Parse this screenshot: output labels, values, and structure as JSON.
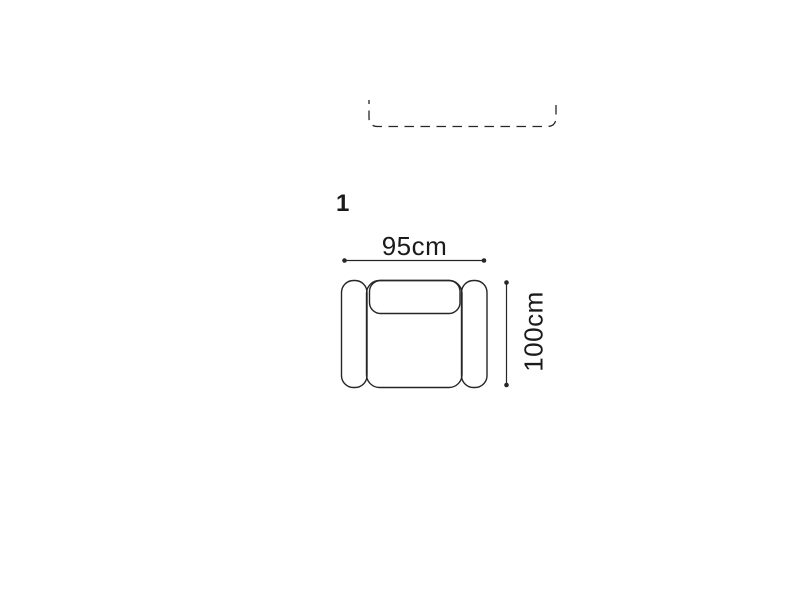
{
  "scene": {
    "background": "#ffffff",
    "line_color": "#262626",
    "text_color": "#1a1a1a",
    "description": "Top-view dimension diagram of an armchair module with a dashed outline of an adjacent module clipped at the top edge"
  },
  "module": {
    "index_label": "1",
    "width_label": "95cm",
    "height_label": "100cm"
  }
}
